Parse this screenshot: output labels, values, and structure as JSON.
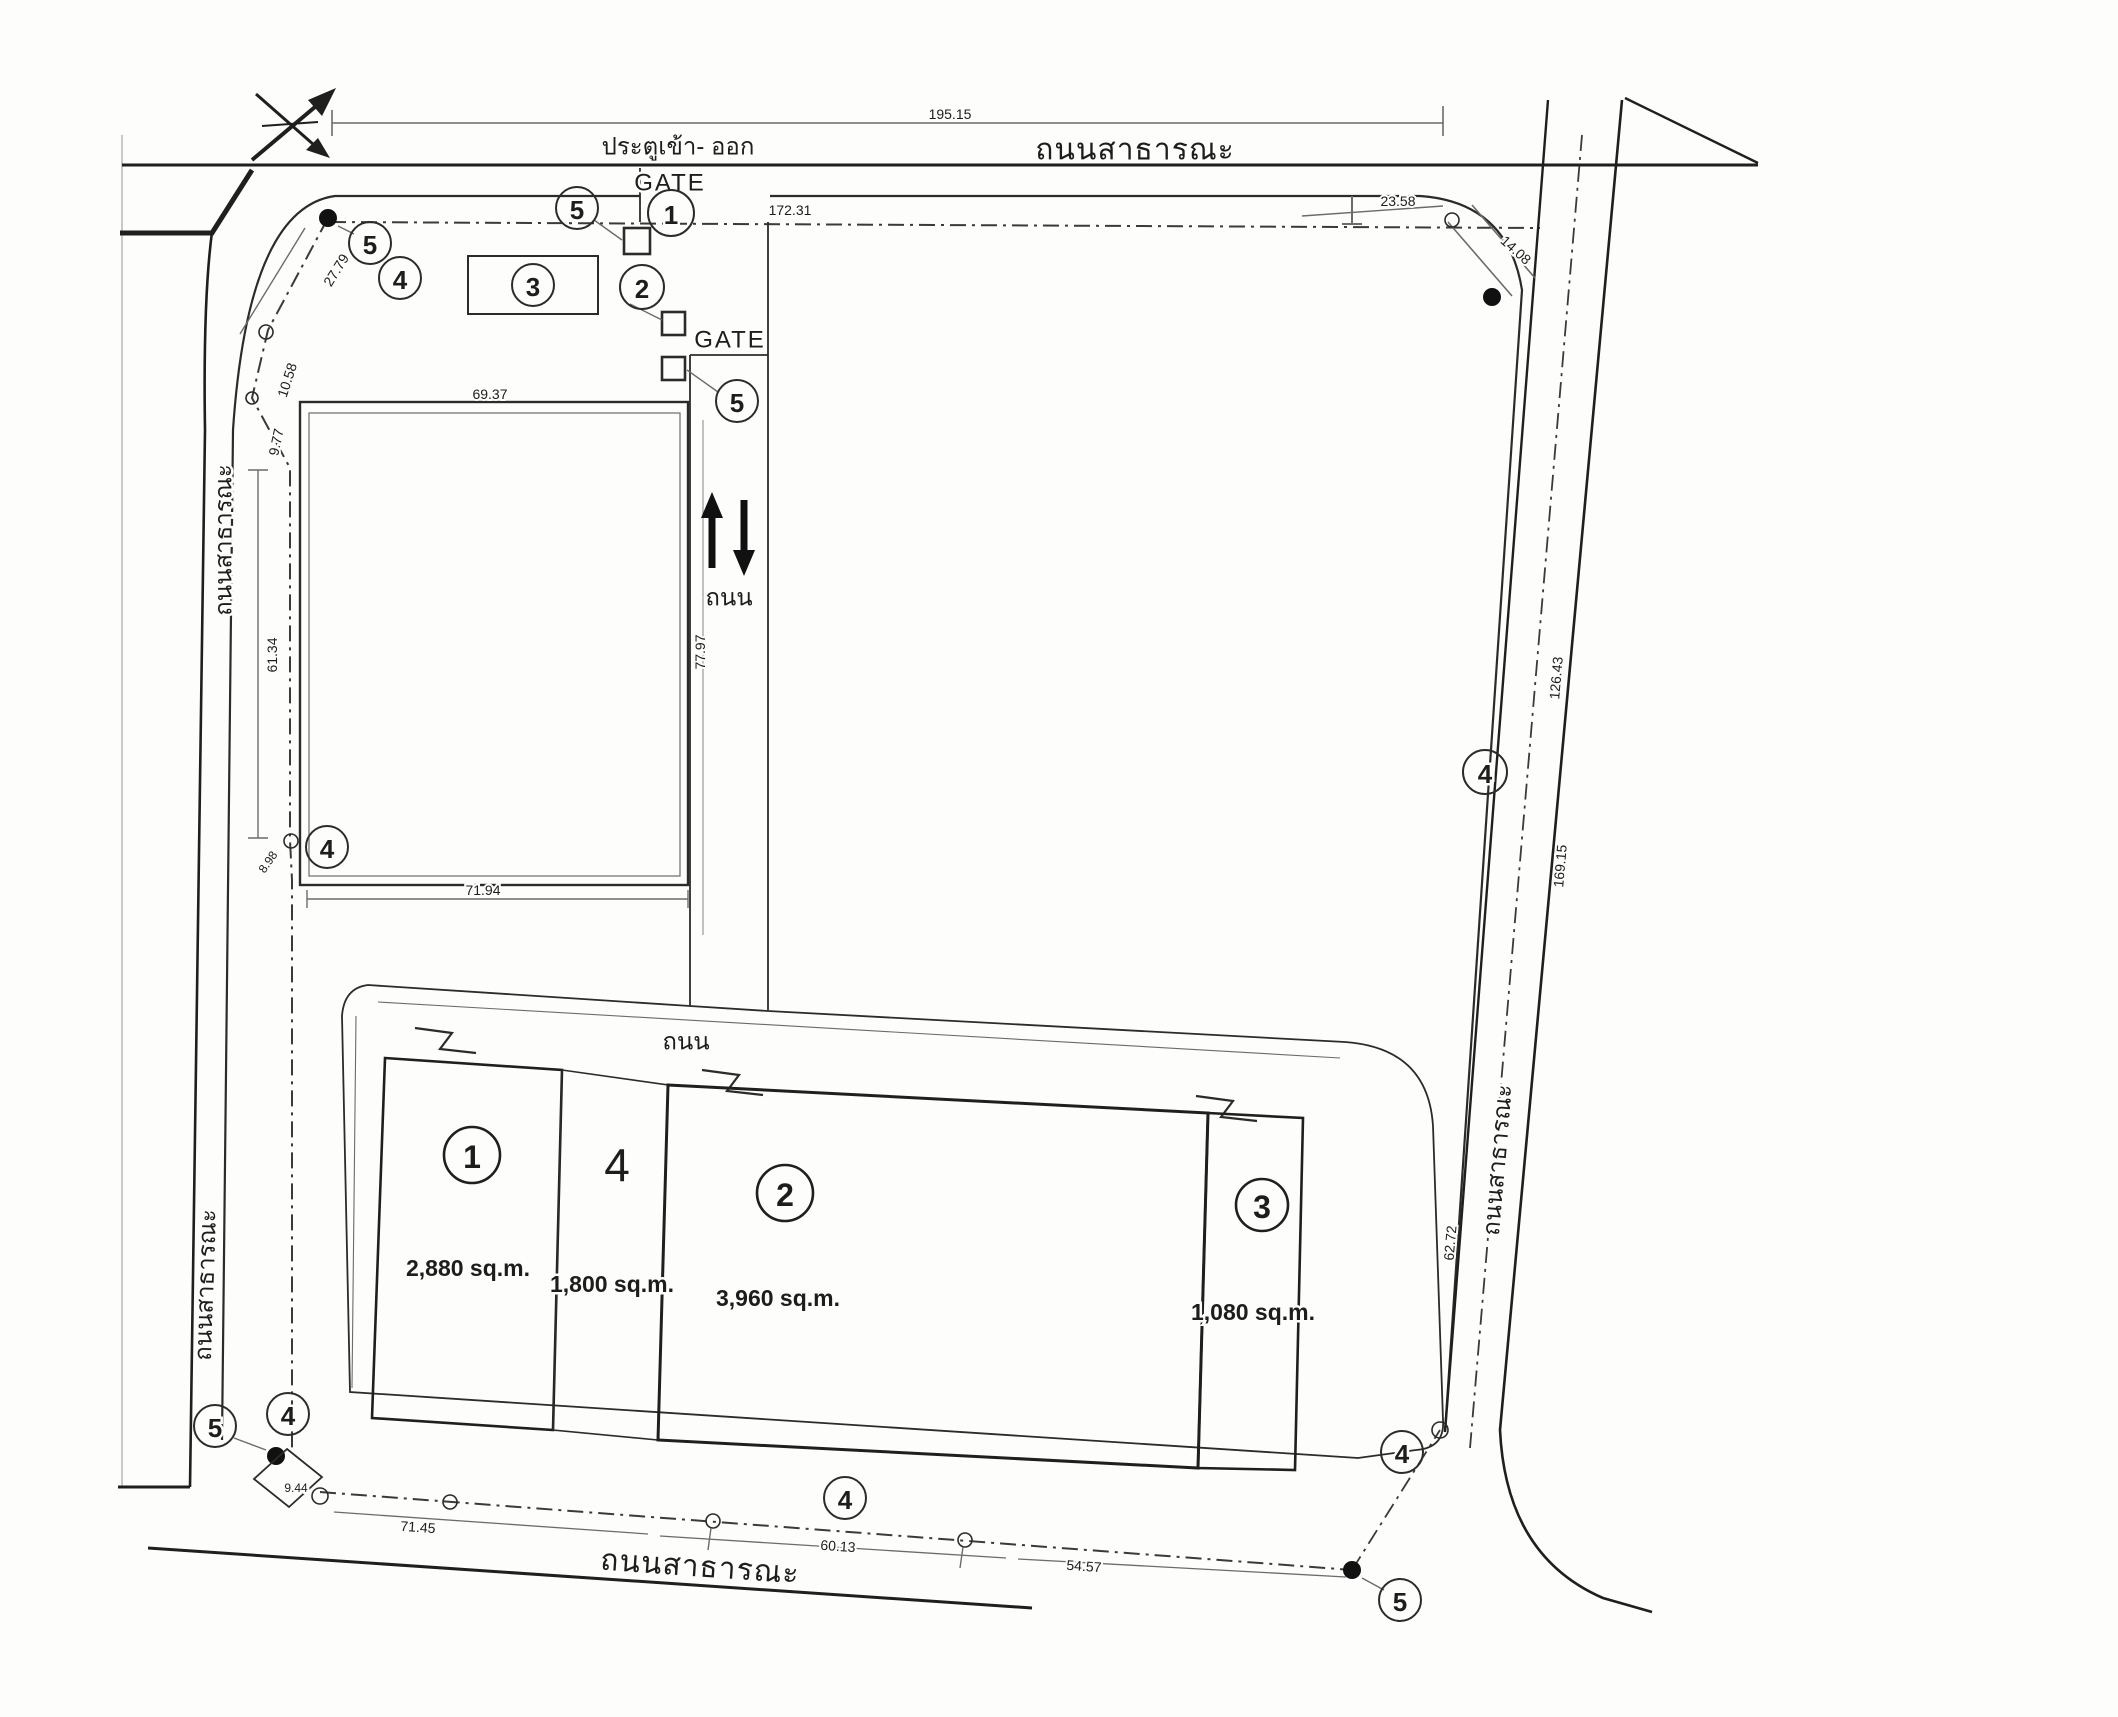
{
  "drawing": {
    "kind": "land-subdivision-site-plan",
    "roads": {
      "top": "ถนนสาธารณะ",
      "left_upper": "ถนนสาธารณะ",
      "left_lower": "ถนนสาธารณะ",
      "right": "ถนนสาธารณะ",
      "bottom": "ถนนสาธารณะ",
      "internal": "ถนน",
      "internal_bottom": "ถนน"
    },
    "gates": {
      "entrance": "ประตูเข้า- ออก",
      "gate1": "GATE",
      "gate2": "GATE"
    },
    "markers": {
      "n1": "1",
      "n2": "2",
      "n3": "3",
      "n4": "4",
      "n5": "5"
    },
    "dims": {
      "top_total": "195.15",
      "top_seg_left": "172.31",
      "top_seg_right": "23.58",
      "corner_chamfer": "14.08",
      "right_upper": "126.43",
      "right_lower": "169.15",
      "right_bottom": "62.72",
      "left_diag": "27.79",
      "left_a": "10.58",
      "left_b": "9.77",
      "left_vert": "61.34",
      "left_c": "8.98",
      "bld_top": "69.37",
      "bld_side": "77.97",
      "bld_bottom": "71.94",
      "bottom_a": "71.45",
      "bottom_b": "60.13",
      "bottom_c": "54.57",
      "bottom_corner": "9.44"
    },
    "plots": [
      {
        "no": "1",
        "area": "2,880 sq.m."
      },
      {
        "no": "4",
        "area": "1,800 sq.m."
      },
      {
        "no": "2",
        "area": "3,960 sq.m."
      },
      {
        "no": "3",
        "area": "1,080 sq.m."
      }
    ]
  }
}
